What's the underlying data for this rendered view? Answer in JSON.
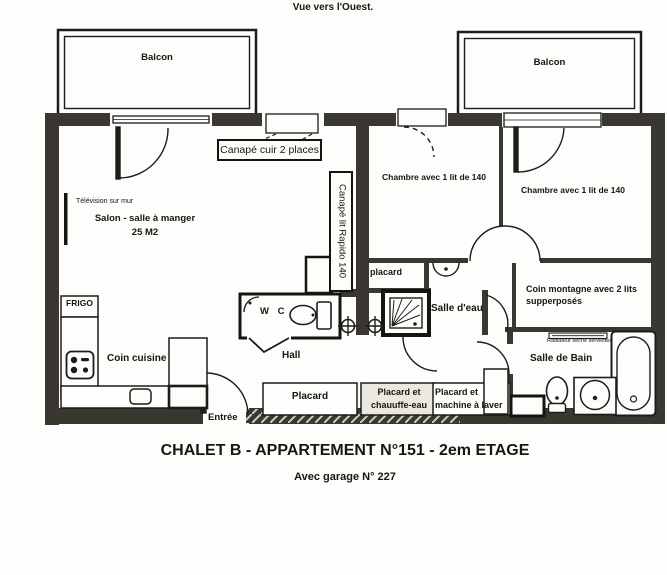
{
  "header": {
    "view_note": "Vue vers l'Ouest."
  },
  "footer": {
    "title": "CHALET B - APPARTEMENT N°151 - 2em ETAGE",
    "subtitle": "Avec garage N° 227"
  },
  "rooms": {
    "balcony_left": "Balcon",
    "balcony_right": "Balcon",
    "salon": "Salon - salle à manger",
    "salon_area": "25 M2",
    "tv_note": "Télévision sur mur",
    "bedroom_left": "Chambre avec 1 lit de 140",
    "bedroom_right": "Chambre avec 1 lit de 140",
    "bunk_room": "Coin montagne avec 2 lits supperposés",
    "shower_room": "Salle d'eau",
    "bathroom": "Salle de Bain",
    "radiator_note": "Radiateur sèche serviettes",
    "wc": "W C",
    "hall": "Hall",
    "kitchen": "Coin cuisine",
    "fridge": "FRIGO",
    "entry": "Entrée",
    "closet_small": "placard",
    "closet_hall": "Placard",
    "closet_heater": "Placard et chauuffe-eau",
    "closet_washer": "Placard et machine à laver"
  },
  "furniture": {
    "sofa": "Canapé cuir 2 places",
    "sofa_bed": "Canapé lit Rapido 140"
  },
  "colors": {
    "wall": "#393730",
    "ink": "#1d1c18",
    "paper": "#fdfdfc"
  }
}
